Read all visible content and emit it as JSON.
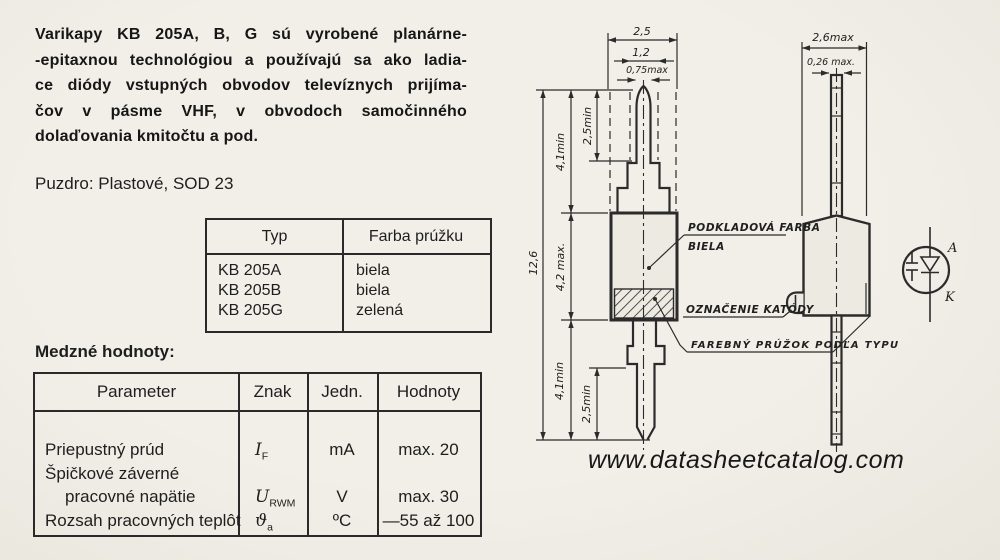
{
  "intro": {
    "lines": [
      "Varikapy KB 205A, B, G sú vyrobené planárne-",
      "-epitaxnou technológiou a používajú sa ako ladia-",
      "ce diódy vstupných obvodov televíznych prijíma-",
      "čov v pásme VHF, v obvodoch samočinného",
      "dolaďovania kmitočtu a pod."
    ],
    "package": "Puzdro: Plastové, SOD 23"
  },
  "type_table": {
    "headers": {
      "type": "Typ",
      "color": "Farba prúžku"
    },
    "rows": [
      {
        "type": "KB 205A",
        "color": "biela"
      },
      {
        "type": "KB 205B",
        "color": "biela"
      },
      {
        "type": "KB 205G",
        "color": "zelená"
      }
    ]
  },
  "limits": {
    "heading": "Medzné hodnoty:",
    "headers": {
      "param": "Parameter",
      "symbol": "Znak",
      "unit": "Jedn.",
      "value": "Hodnoty"
    },
    "rows": [
      {
        "param": "Priepustný prúd",
        "sym": "I",
        "sub": "F",
        "unit": "mA",
        "value": "max. 20"
      },
      {
        "param_line1": "Špičkové záverné",
        "param_line2": "pracovné napätie",
        "sym": "U",
        "sub": "RWM",
        "unit": "V",
        "value": "max. 30"
      },
      {
        "param": "Rozsah pracovných teplôt",
        "sym": "ϑ",
        "sub": "a",
        "unit": "ºC",
        "value": "—55 až 100"
      }
    ]
  },
  "drawing": {
    "front": {
      "dim_width": "2,5",
      "dim_width_inner": "1,2",
      "dim_pin": "0,75max",
      "dim_total": "12,6",
      "dim_lead_top": "4,1min",
      "dim_lead_top_inner": "2,5min",
      "dim_body": "4,2 max.",
      "dim_lead_bottom": "4,1min",
      "dim_lead_bottom_inner": "2,5min"
    },
    "side": {
      "dim_width": "2,6max",
      "dim_lead": "0,26 max."
    },
    "labels": {
      "base_color_line1": "PODKLADOVÁ FARBA",
      "base_color_line2": "BIELA",
      "cathode_mark": "OZNAČENIE KATÓDY",
      "stripe": "FAREBNÝ PRÚŽOK PODĽA TYPU"
    },
    "symbol": {
      "anode": "A",
      "cathode": "K"
    }
  },
  "footer": {
    "watermark": "www.datasheetcatalog.com"
  },
  "colors": {
    "paper": "#f0eee7",
    "ink": "#1e1e1e"
  }
}
